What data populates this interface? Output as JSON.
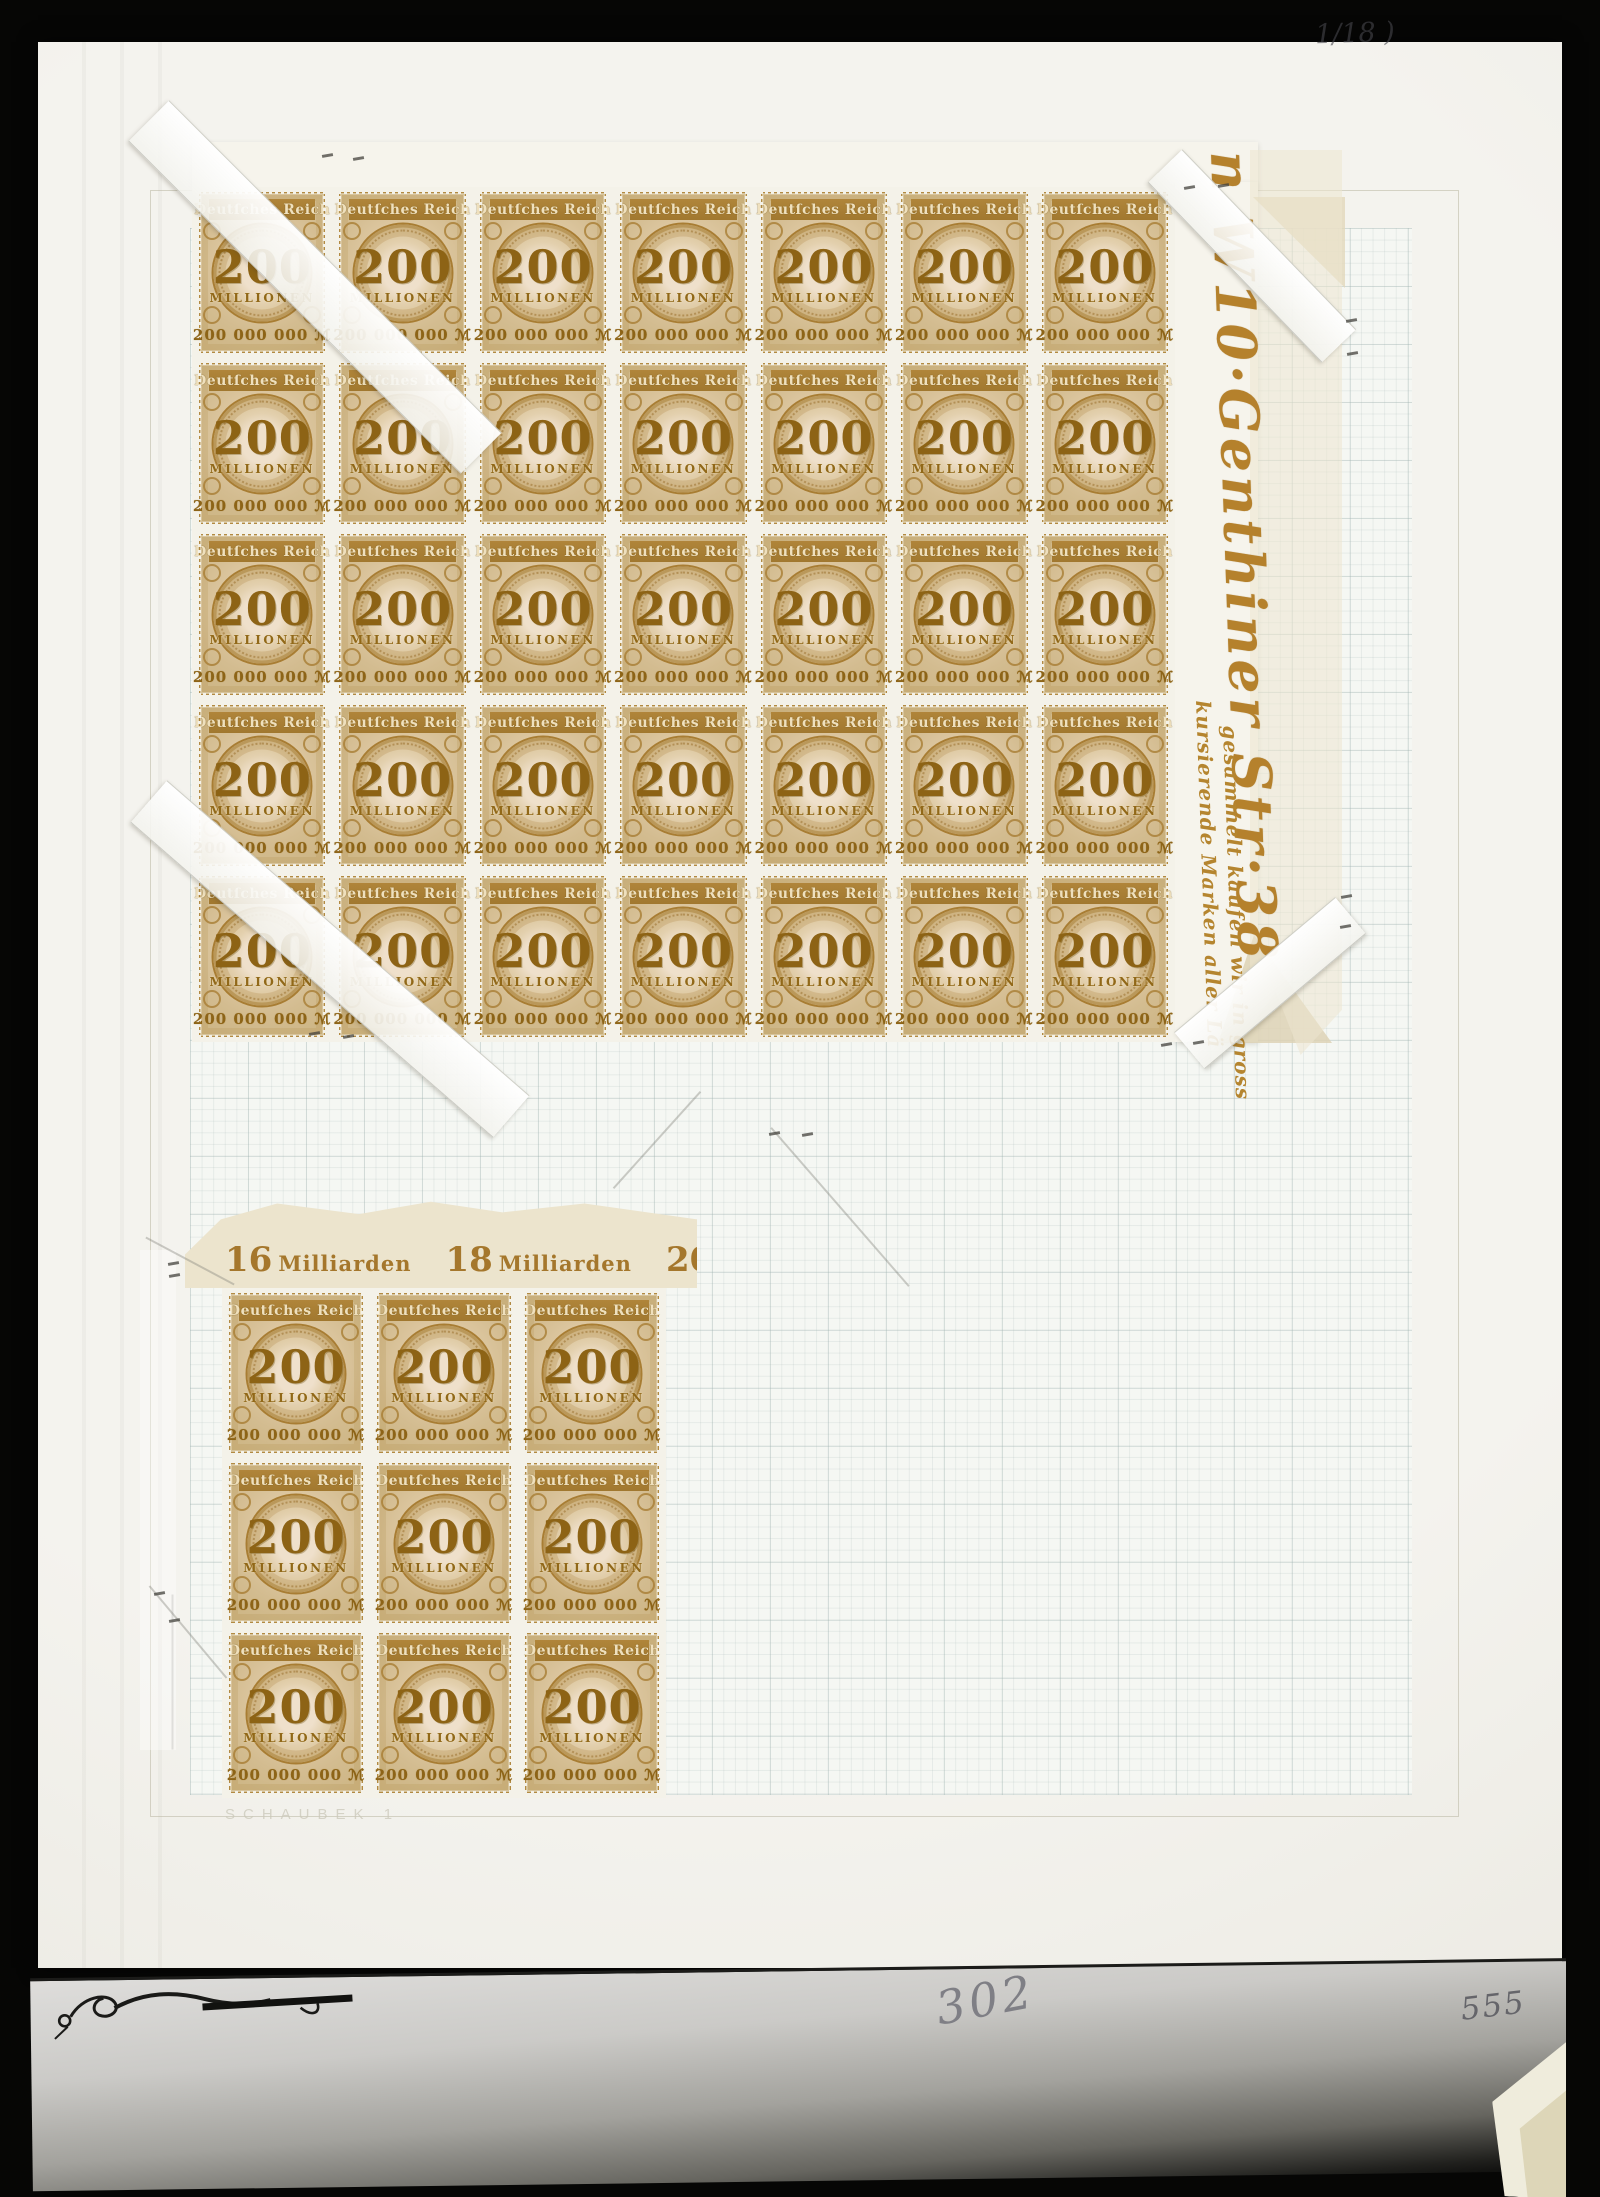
{
  "page": {
    "album_imprint": "SCHAUBEK 1",
    "handwriting_top_right": "1/18 )",
    "handwriting_bottom_center": "302",
    "handwriting_bottom_right": "555"
  },
  "stamp": {
    "country": "Deutſches Reich",
    "value": "200",
    "value_word": "MILLIONEN",
    "value_line": "200 000 000 ℳ"
  },
  "top_sheet": {
    "rows": 5,
    "cols": 7,
    "margin_ad_script": "n W10·Genthiner Str·38",
    "margin_ad_line1": "kursierende Marken aller Lä",
    "margin_ad_line2": "gesammelt kaufen wir in gross"
  },
  "bottom_sheet": {
    "rows": 3,
    "cols": 3,
    "margin_labels": [
      {
        "number": "16",
        "word": "Milliarden"
      },
      {
        "number": "18",
        "word": "Milliarden"
      },
      {
        "number": "20",
        "word": "Milliarden"
      }
    ]
  },
  "colors": {
    "stamp_frame_brown": "#a9803a",
    "stamp_dark_brown": "#8a6118",
    "stamp_paper_tan": "#d6c198",
    "margin_ad_text": "#b5812c",
    "milliarden_text": "#a5772c",
    "pencil_grey": "#7f7f85",
    "page_cream": "#f1f0ea"
  }
}
